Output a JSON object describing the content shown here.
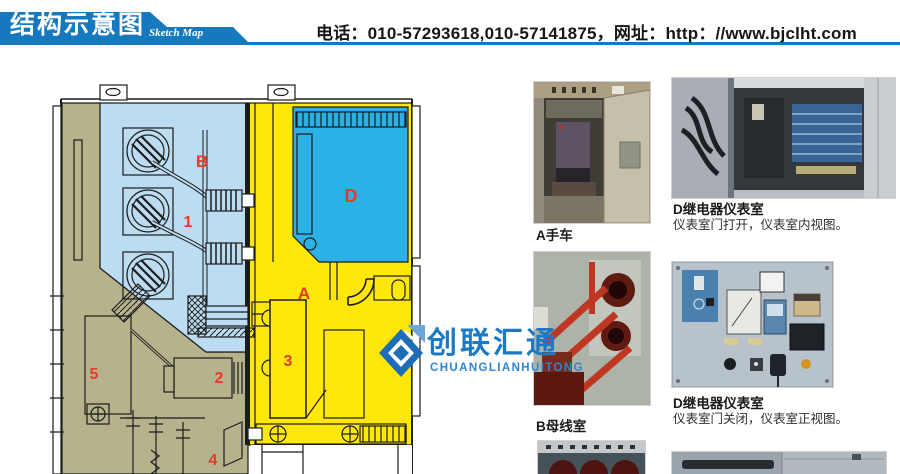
{
  "header": {
    "title_cn": "结构示意图",
    "title_en": "Sketch Map",
    "contact": "电话：010-57293618,010-57141875，网址：http：//www.bjclht.com"
  },
  "watermark": {
    "name_cn": "创联汇通",
    "name_en": "CHUANGLIANHUITONG"
  },
  "diagram": {
    "type": "switchgear-cross-section-sketch",
    "labels": {
      "B": "B",
      "n1": "1",
      "D": "D",
      "A": "A",
      "n3": "3",
      "n2": "2",
      "n5": "5",
      "n4": "4"
    },
    "colors": {
      "busbar_room_blue": "#bcdcf2",
      "instrument_room_cyan": "#2bb1e6",
      "breaker_room_yellow": "#ffe709",
      "cable_room_olive": "#b6b38c",
      "label_red": "#e8392b",
      "banner_blue": "#1779bd",
      "logo_blue": "#1e79c5"
    }
  },
  "photos": [
    {
      "caption": "A手车",
      "desc": ""
    },
    {
      "caption": "D继电器仪表室",
      "desc": "仪表室门打开，仪表室内视图。"
    },
    {
      "caption": "B母线室",
      "desc": ""
    },
    {
      "caption": "D继电器仪表室",
      "desc": "仪表室门关闭，仪表室正视图。"
    }
  ]
}
